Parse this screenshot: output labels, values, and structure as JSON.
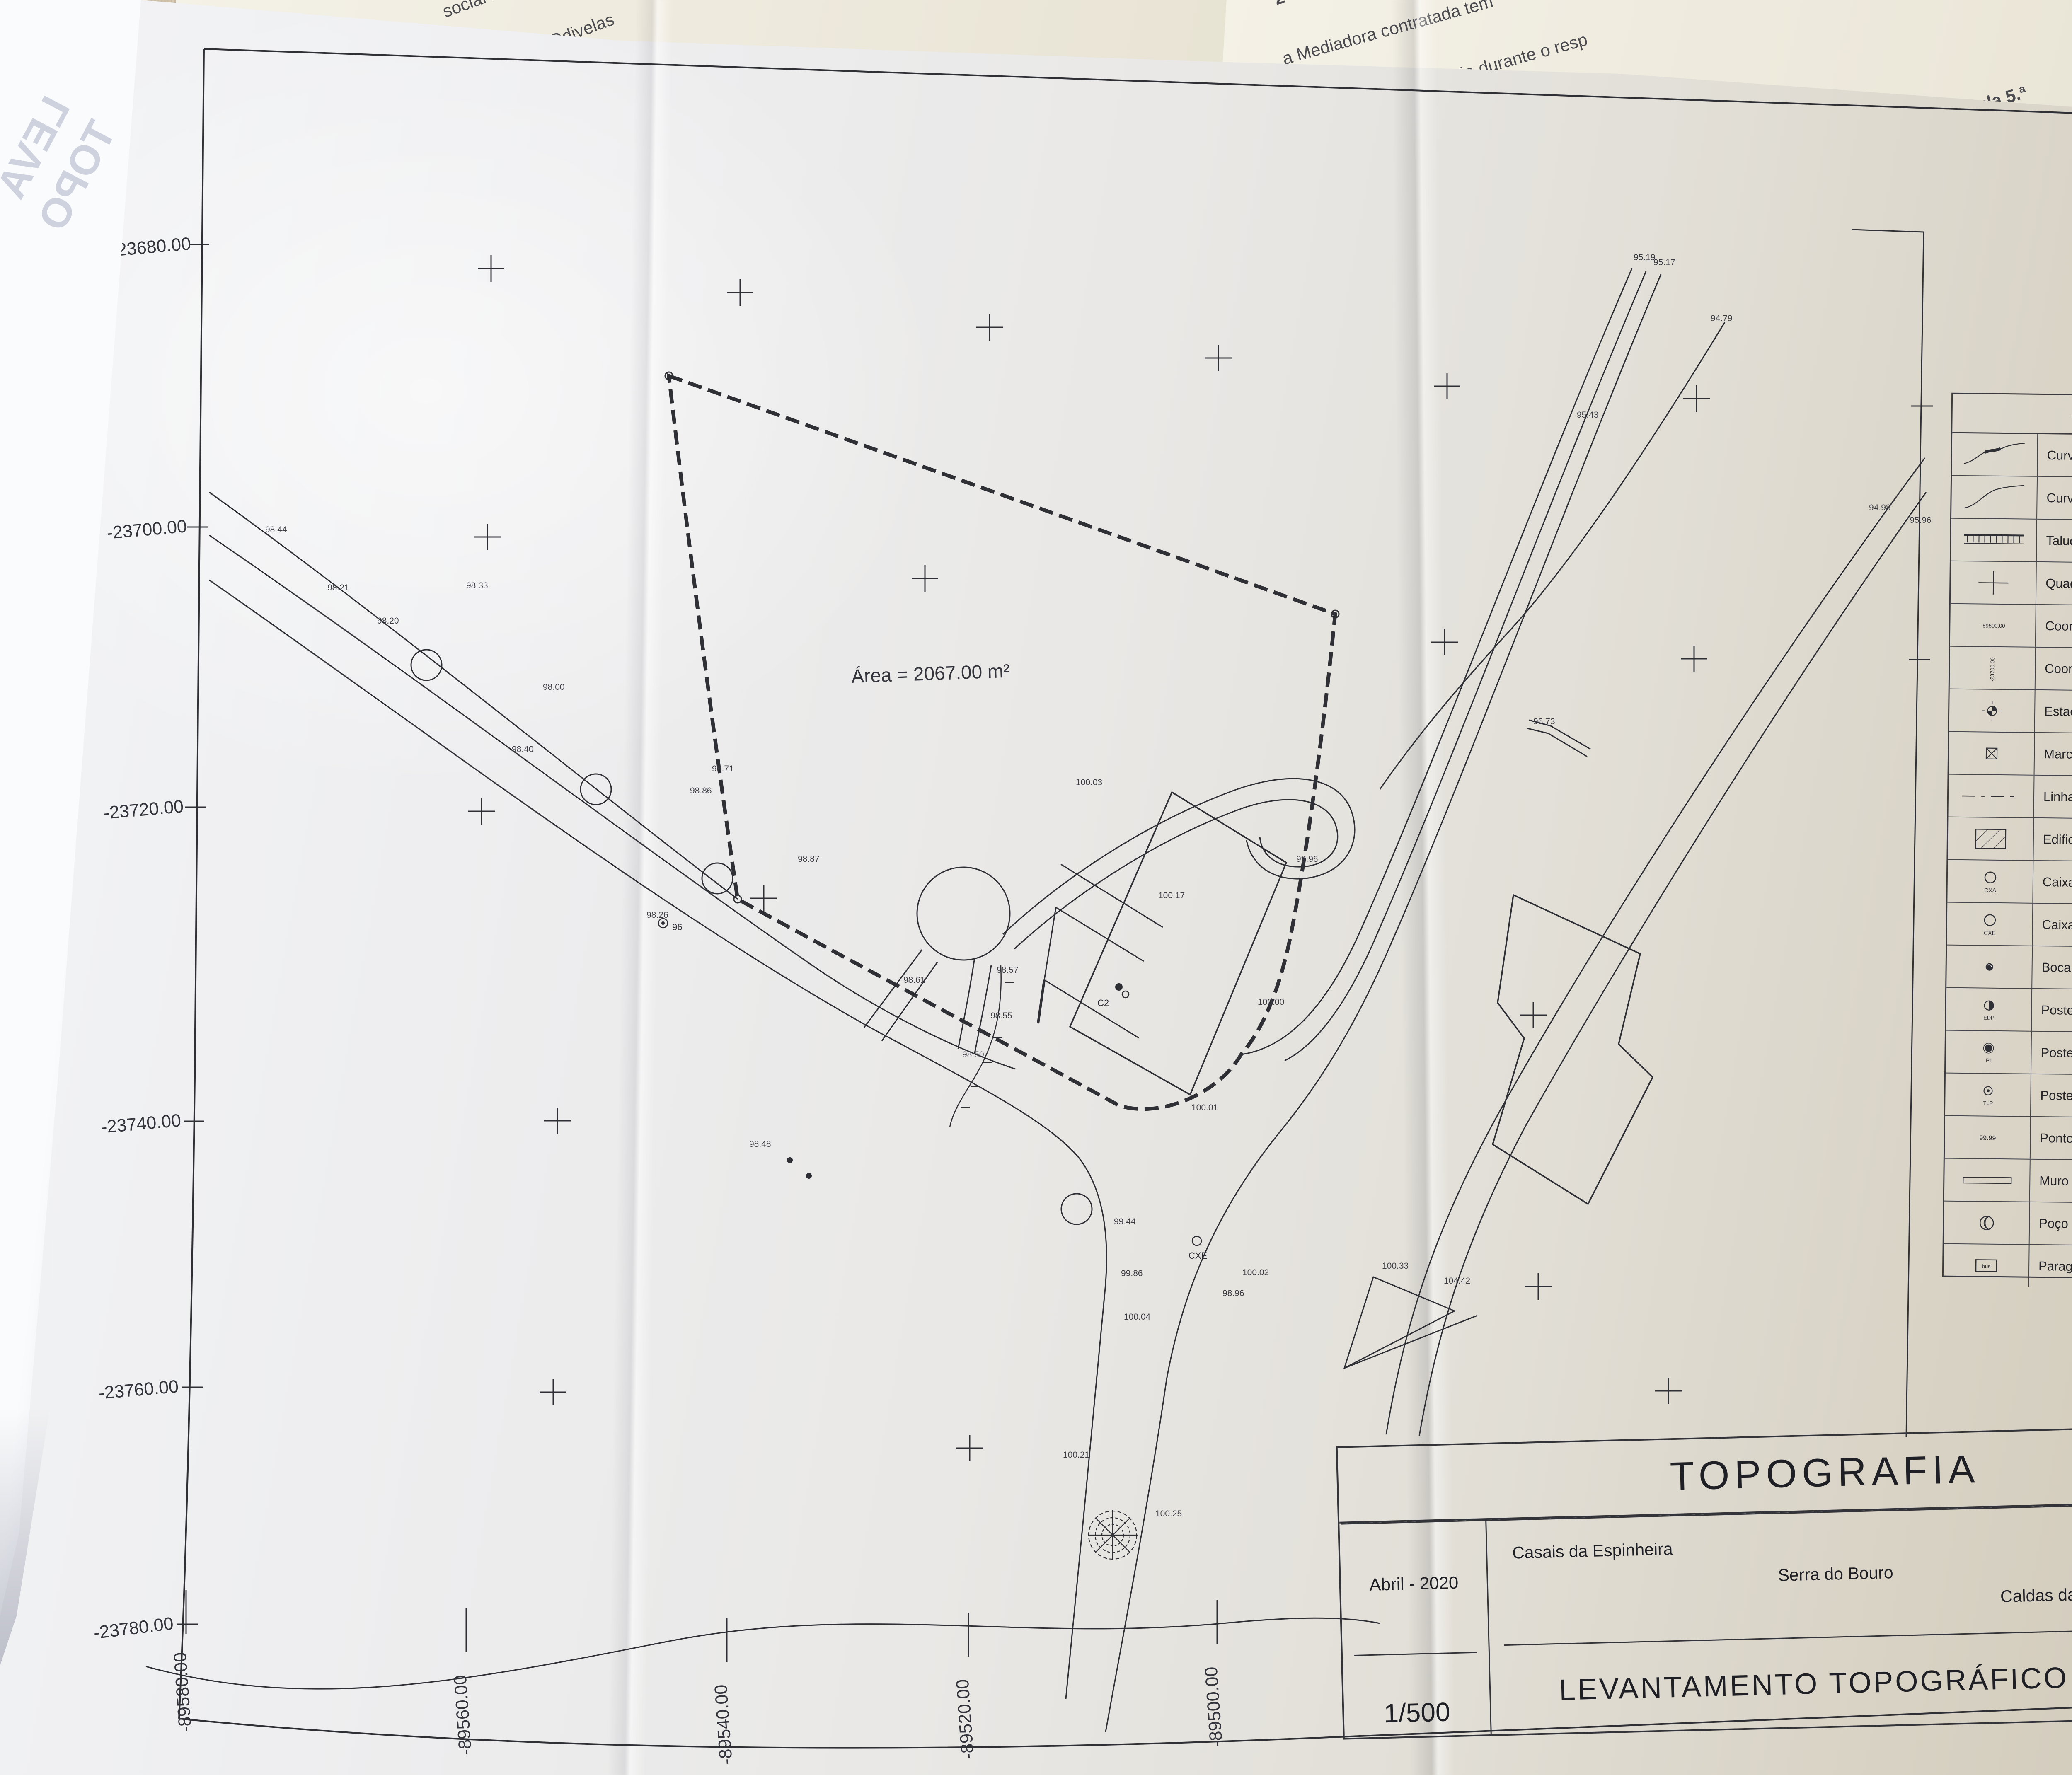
{
  "sheet": {
    "area_label": "Área = 2067.00 m²",
    "north_label": "NORTE",
    "m_coordinates": [
      "-23680.00",
      "-23700.00",
      "-23720.00",
      "-23740.00",
      "-23760.00",
      "-23780.00"
    ],
    "p_coordinates": [
      "-89580.00",
      "-89560.00",
      "-89540.00",
      "-89520.00",
      "-89500.00"
    ],
    "spot_heights": [
      "98.44",
      "98.21",
      "98.20",
      "98.33",
      "98.40",
      "98.00",
      "98.86",
      "98.87",
      "98.26",
      "98.71",
      "98.48",
      "99.44",
      "98.61",
      "98.57",
      "98.55",
      "98.50",
      "99.86",
      "100.04",
      "100.21",
      "100.25",
      "95.19",
      "95.17",
      "94.79",
      "95.43",
      "94.98",
      "95.96",
      "100.03",
      "99.96",
      "100.01",
      "100.17",
      "104.42",
      "100.33",
      "96.73",
      "100.02",
      "98.96",
      "100.00"
    ],
    "markers": [
      "96",
      "C2",
      "CXE"
    ]
  },
  "legend": {
    "title": "SIMBOLOGIA",
    "items": [
      {
        "label": "Curva de nível mestra com cota"
      },
      {
        "label": "Curva de nível secundária"
      },
      {
        "label": "Talude"
      },
      {
        "label": "Quadrícula de coordenação"
      },
      {
        "label": "Coordenada p",
        "caption": "-89500.00"
      },
      {
        "label": "Coordenada m",
        "caption": "-23700.00"
      },
      {
        "label": "Estação"
      },
      {
        "label": "Marco de estrema de propriedade"
      },
      {
        "label": "Linha de estrema"
      },
      {
        "label": "Edificação"
      },
      {
        "label": "Caixa abastecimento de água",
        "caption": "CXA"
      },
      {
        "label": "Caixa de esgoto doméstico",
        "caption": "CXE"
      },
      {
        "label": "Boca de incêndio"
      },
      {
        "label": "Poste distribuição EDP",
        "caption": "EDP"
      },
      {
        "label": "Poste de iluminação",
        "caption": "PI"
      },
      {
        "label": "Poste de telecomunicações",
        "caption": "TLP"
      },
      {
        "label": "Ponto de cota",
        "caption": "99.99"
      },
      {
        "label": "Muro"
      },
      {
        "label": "Poço"
      },
      {
        "label": "Paragem BUS",
        "caption": "bus"
      }
    ]
  },
  "title_block": {
    "title": "TOPOGRAFIA",
    "date": "Abril - 2020",
    "place1": "Casais da Espinheira",
    "place2": "Serra do Bouro",
    "place3": "Caldas da Rainha",
    "scale": "1/500",
    "subtitle": "LEVANTAMENTO TOPOGRÁFICO",
    "sheet_number": "02"
  },
  "background": {
    "doc_left_lines": [
      "social na",
      "Adrião, Odivelas",
      "362107, matriculada na",
      "detentora da",
      "do"
    ],
    "doc_right_lines": [
      "2- O regime",
      "a Mediadora contratada tem",
      "de mediação imobiliária durante o resp",
      "ula 5.ª",
      "ressado que"
    ],
    "edge_fragments": [
      "de",
      "iço",
      "do(",
      "de",
      ")",
      "e",
      "m",
      "(",
      "s",
      "ç",
      "a",
      "g",
      "(",
      "o"
    ]
  },
  "fold": {
    "line1": "LEVA",
    "line2": "TOPO"
  }
}
